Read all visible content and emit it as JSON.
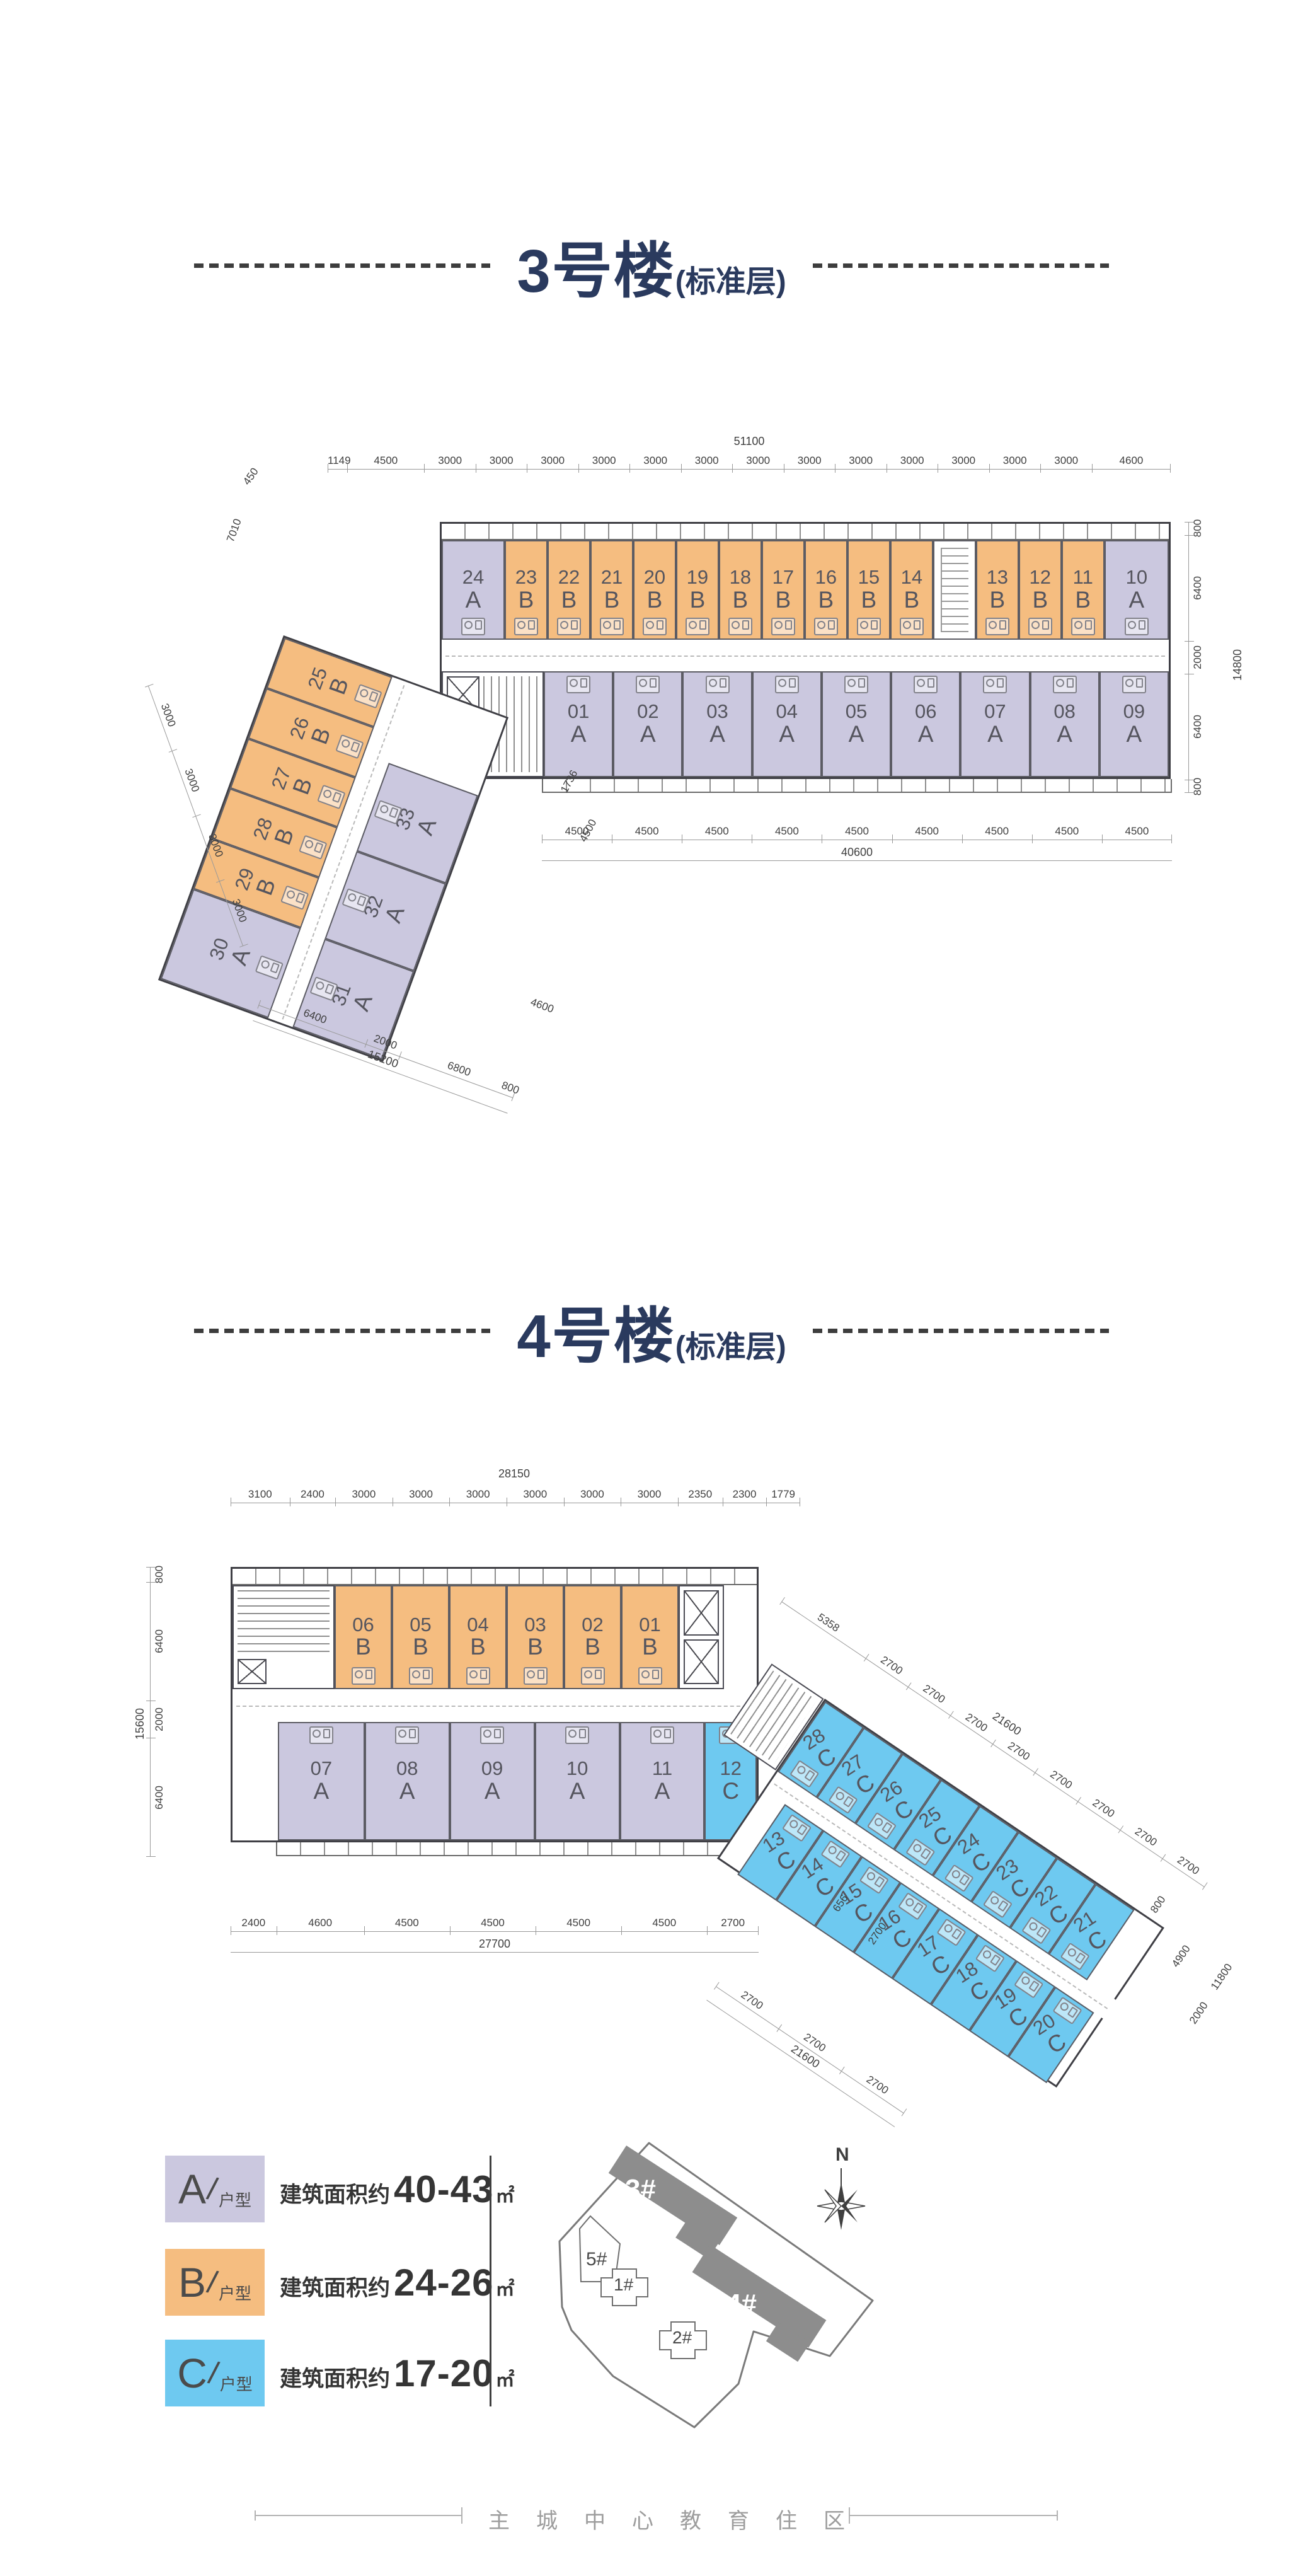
{
  "page": {
    "footer_text": "主城中心教育住区"
  },
  "colors": {
    "type_A": "#cbc8df",
    "type_B": "#f5bd80",
    "type_C": "#6ec9f0",
    "title": "#2a3a5e"
  },
  "legend": [
    {
      "letter": "A",
      "suffix": "户型",
      "prefix": "建筑面积约",
      "range": "40-43",
      "unit": "㎡"
    },
    {
      "letter": "B",
      "suffix": "户型",
      "prefix": "建筑面积约",
      "range": "24-26",
      "unit": "㎡"
    },
    {
      "letter": "C",
      "suffix": "户型",
      "prefix": "建筑面积约",
      "range": "17-20",
      "unit": "㎡"
    }
  ],
  "building3": {
    "title": "3号楼",
    "subtitle": "(标准层)",
    "dims": {
      "top_total": "51100",
      "top": [
        "1149",
        "4500",
        "3000",
        "3000",
        "3000",
        "3000",
        "3000",
        "3000",
        "3000",
        "3000",
        "3000",
        "3000",
        "3000",
        "3000",
        "3000",
        "4600"
      ],
      "right": [
        "800",
        "6400",
        "2000",
        "6400",
        "800"
      ],
      "right_total": "14800",
      "bottom": [
        "4500",
        "4500",
        "4500",
        "4500",
        "4500",
        "4500",
        "4500",
        "4500",
        "4500"
      ],
      "bottom_total": "40600",
      "left_450": "450",
      "left_7010": "7010",
      "corner_1736": "1736",
      "corner_4500": "4500",
      "wing_left": [
        "3000",
        "3000",
        "3000",
        "3000"
      ],
      "wing_bottom": [
        "6400",
        "2000",
        "6800"
      ],
      "wing_bottom_total": "15200",
      "wing_4600": "4600",
      "wing_800": "800"
    },
    "top_row": [
      {
        "no": "24",
        "type": "A"
      },
      {
        "no": "23",
        "type": "B"
      },
      {
        "no": "22",
        "type": "B"
      },
      {
        "no": "21",
        "type": "B"
      },
      {
        "no": "20",
        "type": "B"
      },
      {
        "no": "19",
        "type": "B"
      },
      {
        "no": "18",
        "type": "B"
      },
      {
        "no": "17",
        "type": "B"
      },
      {
        "no": "16",
        "type": "B"
      },
      {
        "no": "15",
        "type": "B"
      },
      {
        "no": "14",
        "type": "B"
      },
      {
        "type": "stair"
      },
      {
        "no": "13",
        "type": "B"
      },
      {
        "no": "12",
        "type": "B"
      },
      {
        "no": "11",
        "type": "B"
      },
      {
        "no": "10",
        "type": "A"
      }
    ],
    "bottom_row": [
      {
        "no": "01",
        "type": "A"
      },
      {
        "no": "02",
        "type": "A"
      },
      {
        "no": "03",
        "type": "A"
      },
      {
        "no": "04",
        "type": "A"
      },
      {
        "no": "05",
        "type": "A"
      },
      {
        "no": "06",
        "type": "A"
      },
      {
        "no": "07",
        "type": "A"
      },
      {
        "no": "08",
        "type": "A"
      },
      {
        "no": "09",
        "type": "A"
      }
    ],
    "wing_col1": [
      {
        "no": "25",
        "type": "B"
      },
      {
        "no": "26",
        "type": "B"
      },
      {
        "no": "27",
        "type": "B"
      },
      {
        "no": "28",
        "type": "B"
      },
      {
        "no": "29",
        "type": "B"
      },
      {
        "no": "30",
        "type": "A"
      }
    ],
    "wing_col2": [
      {
        "no": "33",
        "type": "A"
      },
      {
        "no": "32",
        "type": "A"
      },
      {
        "no": "31",
        "type": "A"
      }
    ]
  },
  "building4": {
    "title": "4号楼",
    "subtitle": "(标准层)",
    "dims": {
      "top_total": "28150",
      "top": [
        "3100",
        "2400",
        "3000",
        "3000",
        "3000",
        "3000",
        "3000",
        "3000",
        "2350",
        "2300",
        "1779"
      ],
      "left": [
        "800",
        "6400",
        "2000",
        "6400"
      ],
      "left_total": "15600",
      "bottom": [
        "2400",
        "4600",
        "4500",
        "4500",
        "4500",
        "4500",
        "2700"
      ],
      "bottom_total": "27700",
      "wing_top": [
        "5358",
        "2700",
        "2700",
        "2700",
        "2700",
        "2700",
        "2700",
        "2700",
        "2700"
      ],
      "wing_top_total": "21600",
      "wing_right": [
        "800",
        "4900",
        "2000",
        "11800"
      ],
      "wing_bottom": [
        "2700",
        "2700",
        "2700"
      ],
      "wing_bottom_total": "21600",
      "junction_656": "656",
      "junction_2700": "2700"
    },
    "top_row": [
      {
        "no": "06",
        "type": "B"
      },
      {
        "no": "05",
        "type": "B"
      },
      {
        "no": "04",
        "type": "B"
      },
      {
        "no": "03",
        "type": "B"
      },
      {
        "no": "02",
        "type": "B"
      },
      {
        "no": "01",
        "type": "B"
      }
    ],
    "bottom_row": [
      {
        "no": "07",
        "type": "A"
      },
      {
        "no": "08",
        "type": "A"
      },
      {
        "no": "09",
        "type": "A"
      },
      {
        "no": "10",
        "type": "A"
      },
      {
        "no": "11",
        "type": "A"
      },
      {
        "no": "12",
        "type": "C"
      }
    ],
    "wing_row1": [
      {
        "no": "28",
        "type": "C"
      },
      {
        "no": "27",
        "type": "C"
      },
      {
        "no": "26",
        "type": "C"
      },
      {
        "no": "25",
        "type": "C"
      },
      {
        "no": "24",
        "type": "C"
      },
      {
        "no": "23",
        "type": "C"
      },
      {
        "no": "22",
        "type": "C"
      },
      {
        "no": "21",
        "type": "C"
      }
    ],
    "wing_row2": [
      {
        "no": "13",
        "type": "C"
      },
      {
        "no": "14",
        "type": "C"
      },
      {
        "no": "15",
        "type": "C"
      },
      {
        "no": "16",
        "type": "C"
      },
      {
        "no": "17",
        "type": "C"
      },
      {
        "no": "18",
        "type": "C"
      },
      {
        "no": "19",
        "type": "C"
      },
      {
        "no": "20",
        "type": "C"
      }
    ]
  },
  "site_plan": {
    "labels": {
      "b3": "3#",
      "b4": "4#",
      "b5": "5#",
      "b1": "1#",
      "b2": "2#"
    },
    "north": "N"
  }
}
